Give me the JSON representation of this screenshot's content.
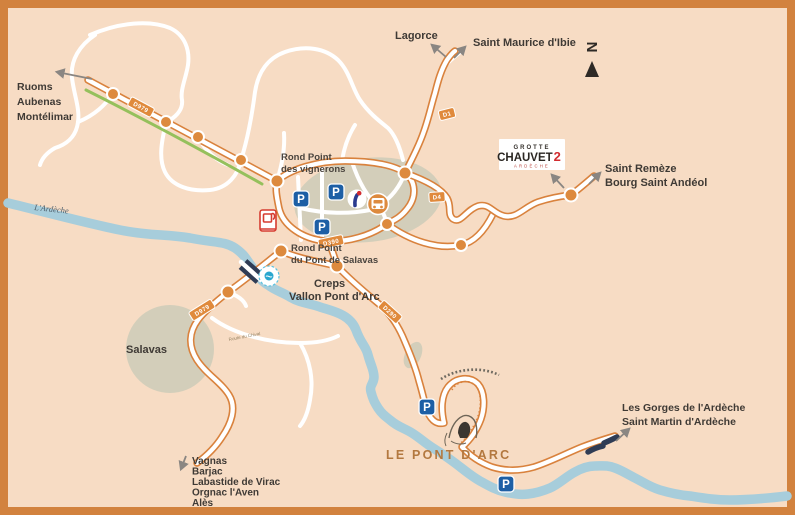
{
  "map": {
    "colors": {
      "border": "#d2823e",
      "background": "#f7dcc4",
      "road": "#d9823d",
      "river": "#a7cddb",
      "bike_path": "#95c05c",
      "parking_blue": "#1d5fa5",
      "bridge_navy": "#2f3c55",
      "label_dark": "#3f3a35",
      "pont_darc_orange": "#b3783f"
    },
    "labels": {
      "ruoms": "Ruoms",
      "aubenas": "Aubenas",
      "montelimar": "Montélimar",
      "lagorce": "Lagorce",
      "saint_maurice": "Saint Maurice d'Ibie",
      "saint_remeze": "Saint Remèze",
      "bourg": "Bourg Saint Andéol",
      "gorges": "Les Gorges de l'Ardèche",
      "saint_martin": "Saint Martin d'Ardèche",
      "vagnas": "Vagnas",
      "barjac": "Barjac",
      "labastide": "Labastide de Virac",
      "orgnac": "Orgnac l'Aven",
      "ales": "Alès",
      "rp_vignerons_1": "Rond Point",
      "rp_vignerons_2": "des vignerons",
      "rp_salavas_1": "Rond Point",
      "rp_salavas_2": "du Pont de Salavas",
      "creps": "Creps",
      "vallon": "Vallon Pont d'Arc",
      "salavas": "Salavas",
      "pont_darc": "LE PONT D'ARC",
      "riviere": "L'Ardèche",
      "route_small": "Route du Chival",
      "north": "N",
      "parking": "P"
    },
    "roads": {
      "d979": "D979",
      "d1": "D1",
      "d4": "D4",
      "d390": "D390",
      "d290": "D290"
    },
    "logo": {
      "grotte": "GROTTE",
      "chauvet": "CHAUVET",
      "num": "2",
      "ardeche": "ARDÈCHE"
    }
  }
}
